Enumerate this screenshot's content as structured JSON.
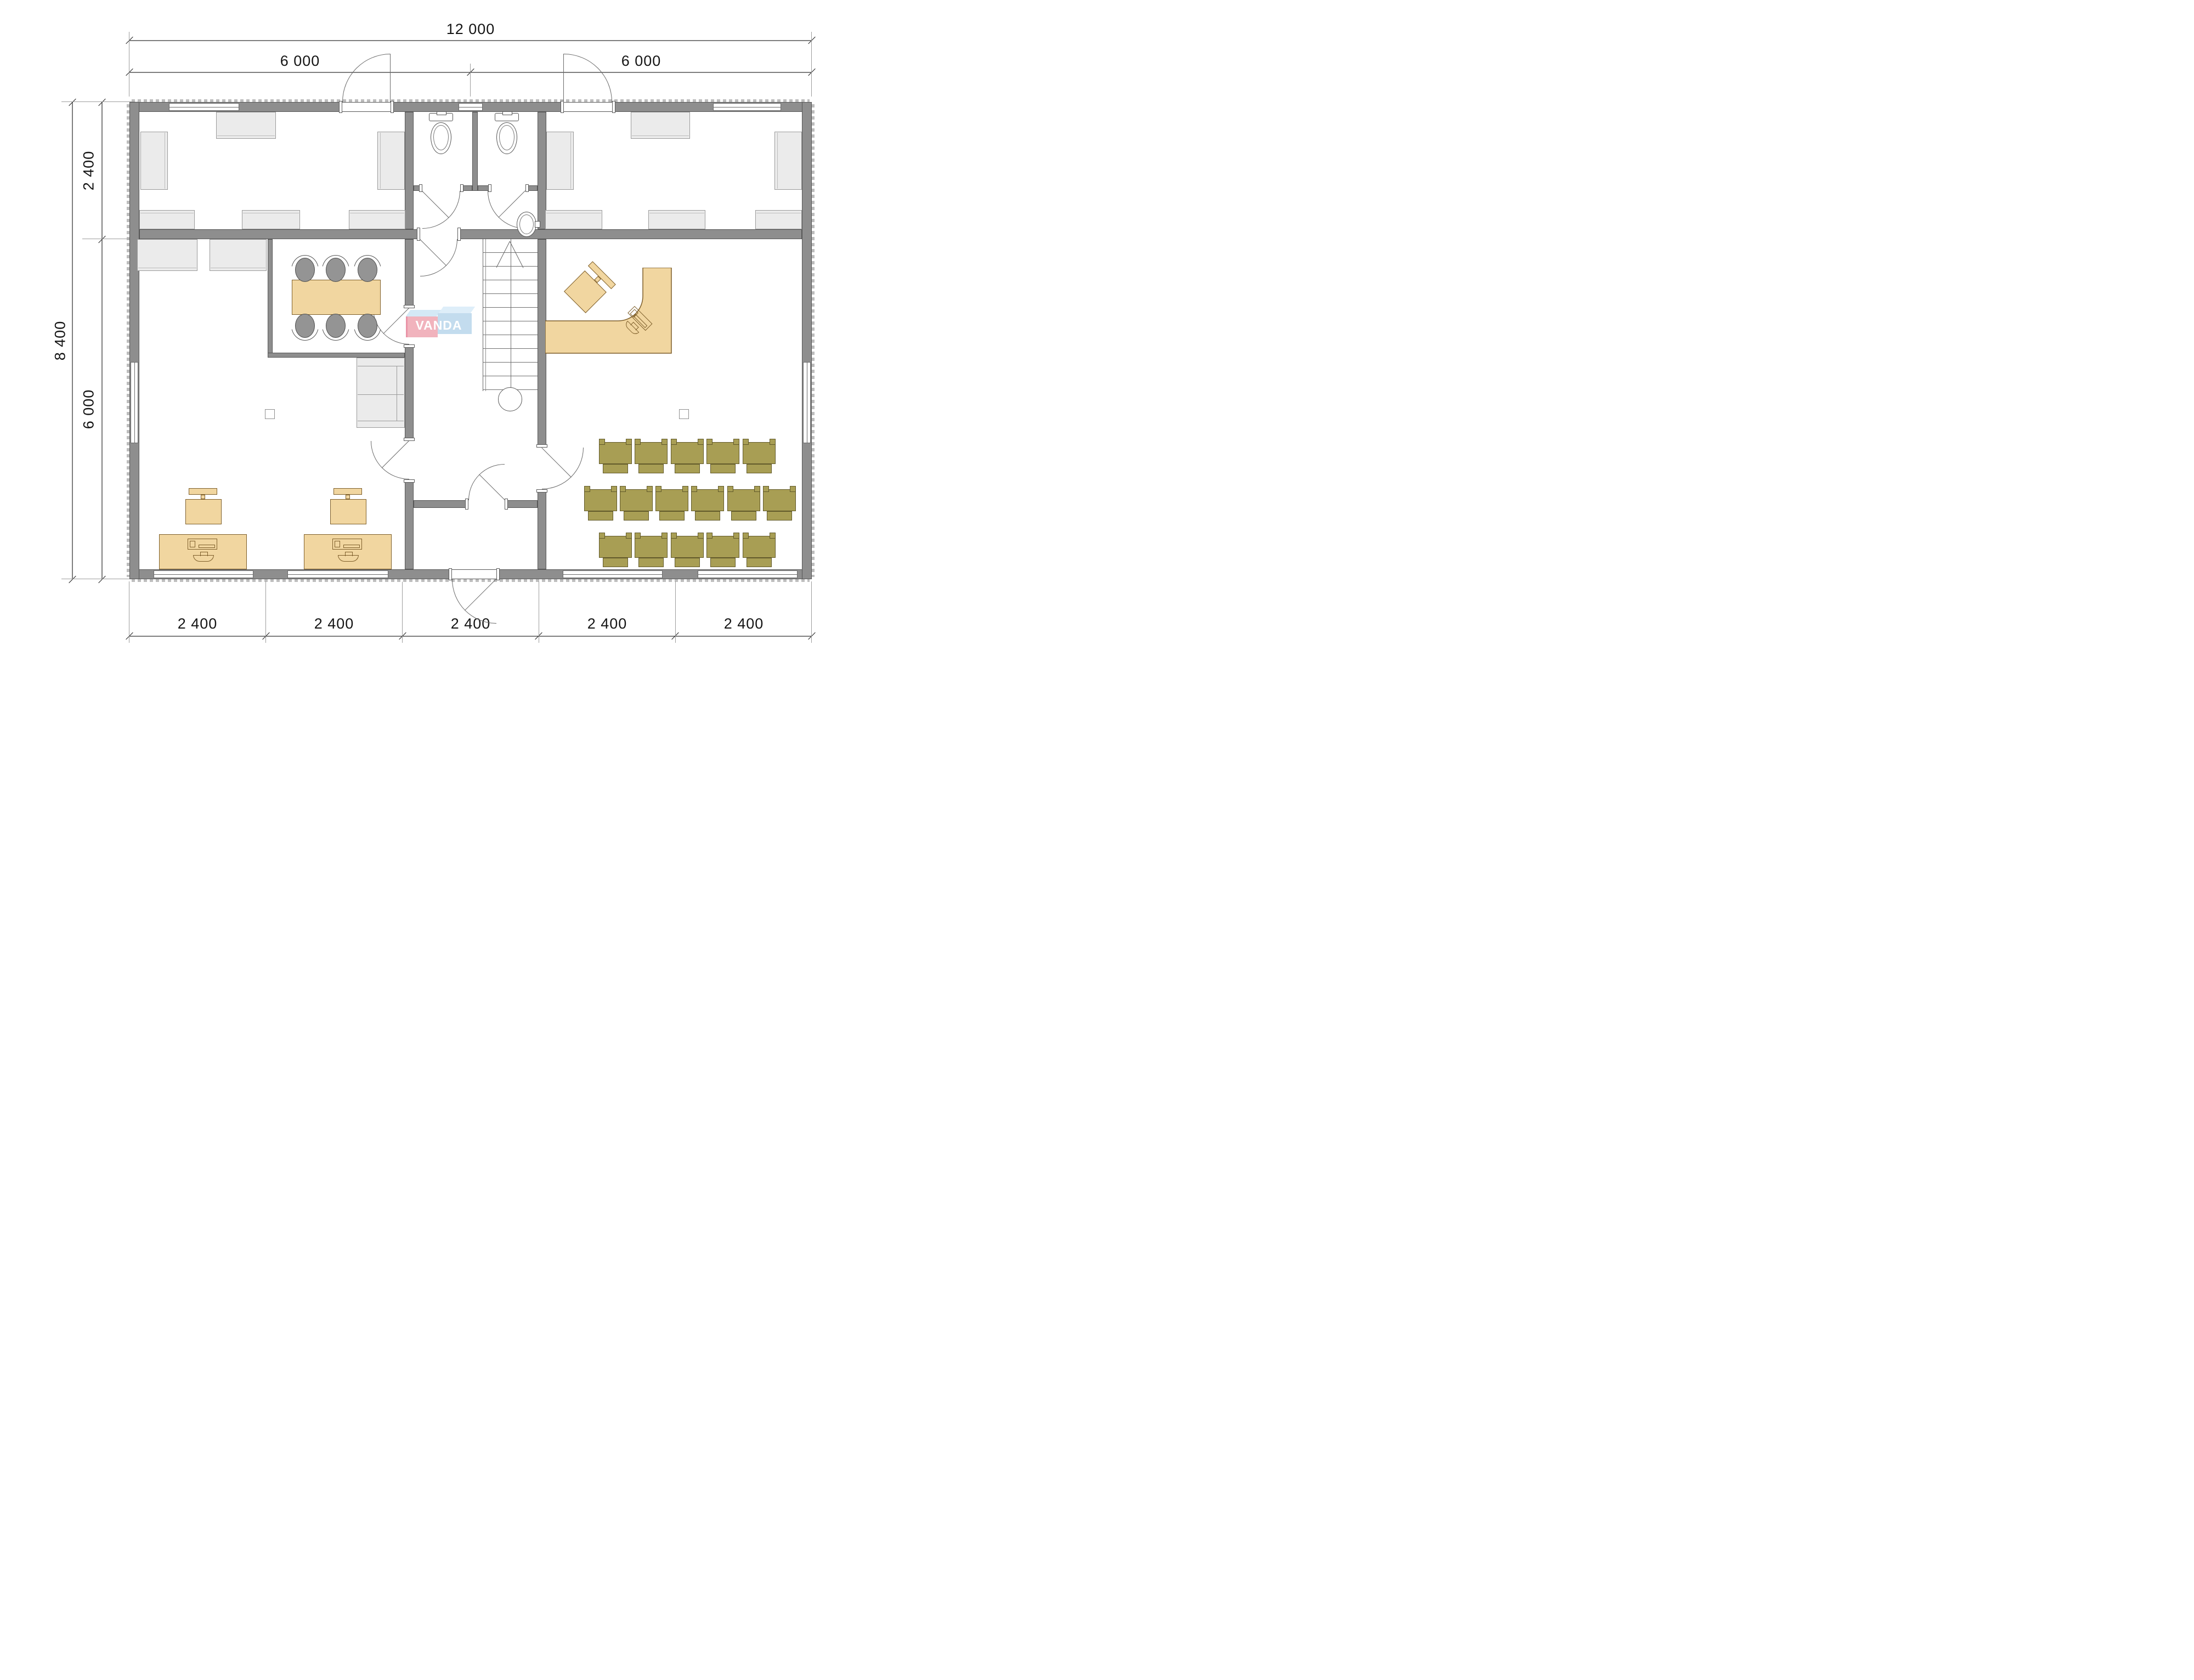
{
  "drawing": {
    "type": "architectural floor plan",
    "watermark": "VANDA"
  },
  "logo": {
    "text": "VANDA"
  },
  "dimensions": {
    "top_total": "12 000",
    "top_spans": [
      "6 000",
      "6 000"
    ],
    "left_total": "8 400",
    "left_spans": [
      "2 400",
      "6 000"
    ],
    "bottom_spans": [
      "2 400",
      "2 400",
      "2 400",
      "2 400",
      "2 400"
    ]
  },
  "furniture": {
    "theater_seat_rows": [
      5,
      6,
      5
    ],
    "meeting_chairs": 6,
    "desks": 2,
    "toilets": 2,
    "sinks": 1
  },
  "colors": {
    "wall": "#8e8e8e",
    "wood": "#f1d6a0",
    "olive_seating": "#a89e54",
    "cabinet": "#ebebeb",
    "logo_pink": "#efa6b2",
    "logo_blue": "#b9d6ec"
  }
}
